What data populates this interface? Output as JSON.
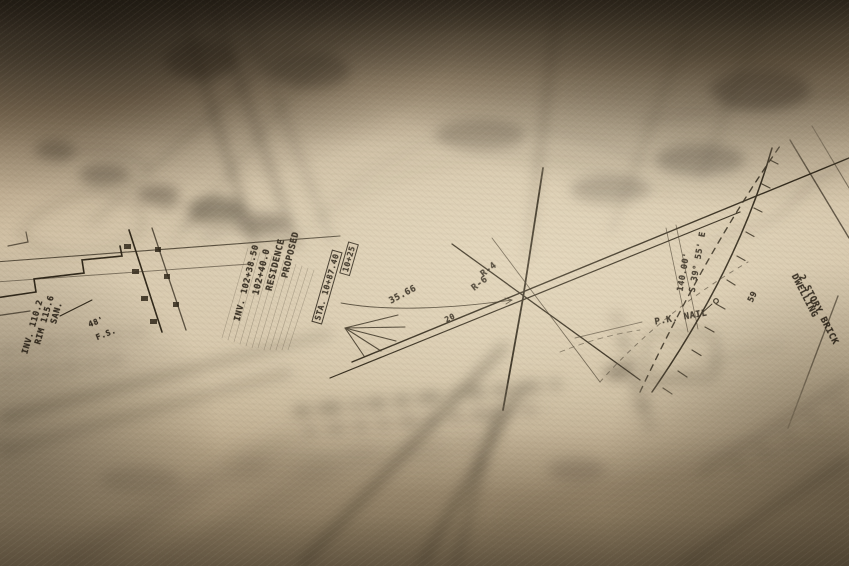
{
  "photo": {
    "description": "Close-up photograph of a hand-drafted civil survey site plan on aged paper; shallow depth of field with a sharp horizontal band across the middle and heavy blur at top and bottom."
  },
  "palette": {
    "paper": "#d6c8ae",
    "ink": "#32291c",
    "shadow_top": "#4b4233",
    "foreground_haze": "#a4927a",
    "highlight": "#ecdfc4"
  },
  "map_labels": [
    {
      "name": "proposed",
      "text": "PROPOSED",
      "x": 291,
      "y": 255,
      "rot": -76,
      "size": 9,
      "boxed": false
    },
    {
      "name": "residence",
      "text": "RESIDENCE",
      "x": 276,
      "y": 265,
      "rot": -76,
      "size": 9,
      "boxed": false
    },
    {
      "name": "station-value",
      "text": "102+40.0",
      "x": 262,
      "y": 272,
      "rot": -76,
      "size": 9,
      "boxed": false
    },
    {
      "name": "invert-value",
      "text": "INV. 102+38.50",
      "x": 247,
      "y": 283,
      "rot": -76,
      "size": 8.5,
      "boxed": false
    },
    {
      "name": "sta-box",
      "text": "STA. 10+87.40",
      "x": 327,
      "y": 287,
      "rot": -74,
      "size": 8,
      "boxed": true
    },
    {
      "name": "offset-box",
      "text": "10+25",
      "x": 349,
      "y": 259,
      "rot": -74,
      "size": 8,
      "boxed": true
    },
    {
      "name": "distance-3566",
      "text": "35.66",
      "x": 403,
      "y": 295,
      "rot": -28,
      "size": 9,
      "boxed": false
    },
    {
      "name": "number-20",
      "text": "20",
      "x": 450,
      "y": 318,
      "rot": -28,
      "size": 8,
      "boxed": false
    },
    {
      "name": "line-r4",
      "text": "R-4",
      "x": 489,
      "y": 270,
      "rot": -38,
      "size": 9,
      "boxed": false
    },
    {
      "name": "line-r6",
      "text": "R-6",
      "x": 480,
      "y": 284,
      "rot": -38,
      "size": 9,
      "boxed": false
    },
    {
      "name": "bearing",
      "text": "S 39° 55' E",
      "x": 698,
      "y": 262,
      "rot": -80,
      "size": 8.5,
      "boxed": false
    },
    {
      "name": "distance-140",
      "text": "140.00'",
      "x": 684,
      "y": 272,
      "rot": -80,
      "size": 8.5,
      "boxed": false
    },
    {
      "name": "pk-nail",
      "text": "P.K. NAIL",
      "x": 681,
      "y": 318,
      "rot": -10,
      "size": 9,
      "boxed": false
    },
    {
      "name": "contour-59",
      "text": "59",
      "x": 753,
      "y": 297,
      "rot": -64,
      "size": 8.5,
      "boxed": false
    },
    {
      "name": "dwelling",
      "text": "DWELLING",
      "x": 804,
      "y": 296,
      "rot": 63,
      "size": 9,
      "boxed": false
    },
    {
      "name": "story-brick",
      "text": "2 STORY BRICK",
      "x": 818,
      "y": 310,
      "rot": 63,
      "size": 9,
      "boxed": false
    },
    {
      "name": "san-mh",
      "text": "SAN.",
      "x": 57,
      "y": 313,
      "rot": -74,
      "size": 8.5,
      "boxed": false
    },
    {
      "name": "rim-elev",
      "text": "RIM 115.6",
      "x": 45,
      "y": 320,
      "rot": -74,
      "size": 8.5,
      "boxed": false
    },
    {
      "name": "inv-elev",
      "text": "INV. 110.2",
      "x": 33,
      "y": 327,
      "rot": -74,
      "size": 8.5,
      "boxed": false
    },
    {
      "name": "distance-48",
      "text": "48'",
      "x": 96,
      "y": 322,
      "rot": -22,
      "size": 8,
      "boxed": false
    },
    {
      "name": "fs-mark",
      "text": "F.S.",
      "x": 106,
      "y": 334,
      "rot": -22,
      "size": 8,
      "boxed": false
    }
  ]
}
